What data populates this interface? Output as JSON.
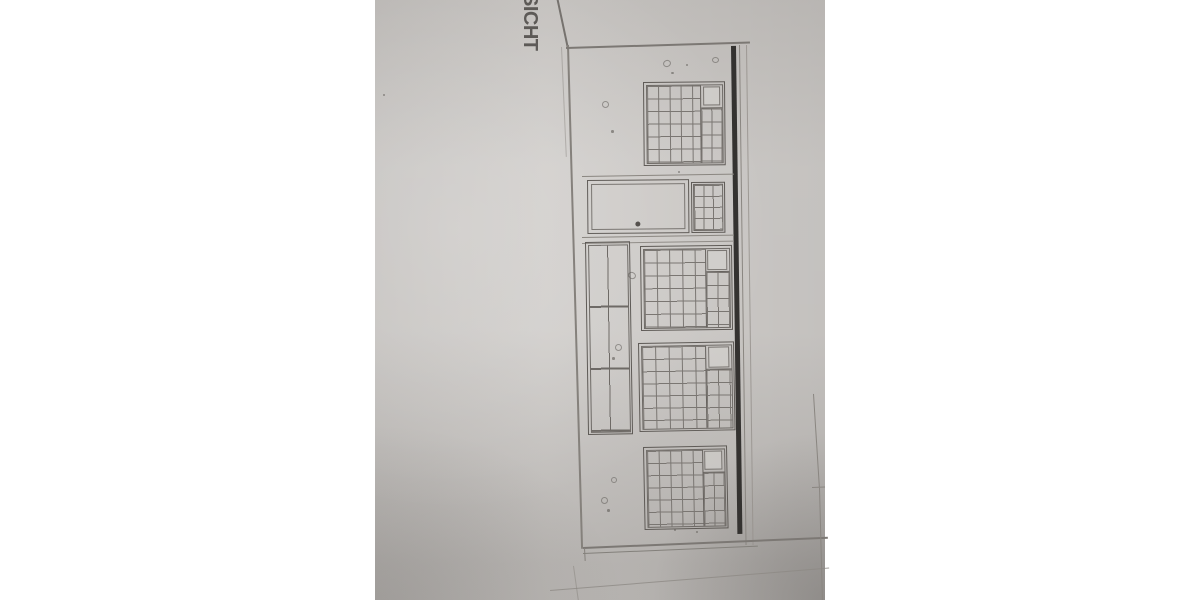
{
  "photo": {
    "kind": "photograph of an architectural elevation drawing, rotated 90 degrees",
    "label_fragment": "SICHT",
    "colors": {
      "background": "#ffffff",
      "paper": "#cbc8c5",
      "pencil_line": "#7c7874",
      "window_frame": "#5f5b57",
      "thick_ground_line": "#343230",
      "label_text": "#4b4845"
    }
  },
  "drawing": {
    "label_fragment": "SICHT",
    "facade": {
      "gridded_windows": [
        {
          "id": "window-top",
          "main_grid": "5x7",
          "corner_pane": true,
          "side_grid": "2x4"
        },
        {
          "id": "window-mid-1",
          "main_grid": "5x6",
          "corner_pane": true,
          "side_grid": "2x4"
        },
        {
          "id": "window-mid-2",
          "main_grid": "5x7",
          "corner_pane": true,
          "side_grid": "2x4"
        },
        {
          "id": "window-bottom",
          "main_grid": "5x7",
          "corner_pane": true,
          "side_grid": "2x4"
        }
      ],
      "small_window": {
        "id": "window-small",
        "grid": "3x4"
      },
      "tall_window": {
        "id": "window-tall",
        "grid": "2x3"
      },
      "door": {
        "has_knob": true
      },
      "thick_edge_line": true,
      "ground_lines": 3
    }
  }
}
